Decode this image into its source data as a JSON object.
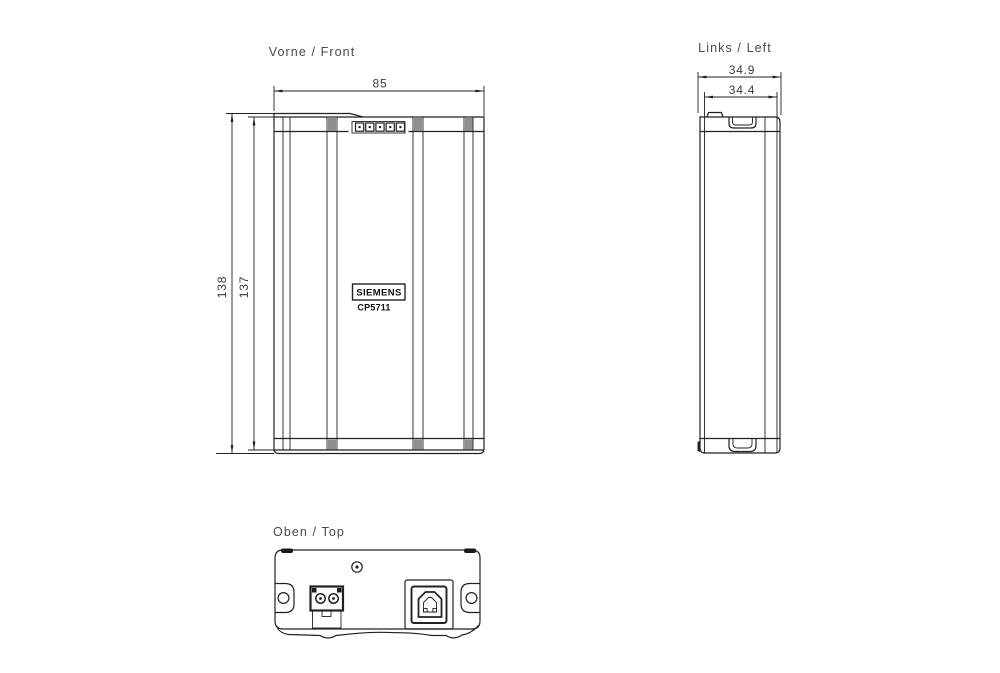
{
  "views": {
    "front": {
      "label": "Vorne / Front",
      "width_dim": "85",
      "height_outer_dim": "138",
      "height_inner_dim": "137",
      "brand": "SIEMENS",
      "model": "CP5711",
      "led_count": 5
    },
    "left": {
      "label": "Links / Left",
      "depth_outer_dim": "34.9",
      "depth_inner_dim": "34.4"
    },
    "top": {
      "label": "Oben / Top"
    }
  },
  "icons": {
    "led_indicator": "small-square-with-dot",
    "screw_hole": "circle-with-center-dot",
    "mounting_hole": "circle-in-rounded-lobe",
    "usb_b_port": "chamfered-square-usb-b",
    "power_connector": "two-pin-round-terminals",
    "din_latch": "trapezoid-tab",
    "dimension_arrow": "slim-filled-triangle"
  },
  "colors": {
    "line": "#212121",
    "dim_text": "#3c3c3c",
    "accent_gray": "#8f8f8f",
    "background": "#ffffff"
  }
}
